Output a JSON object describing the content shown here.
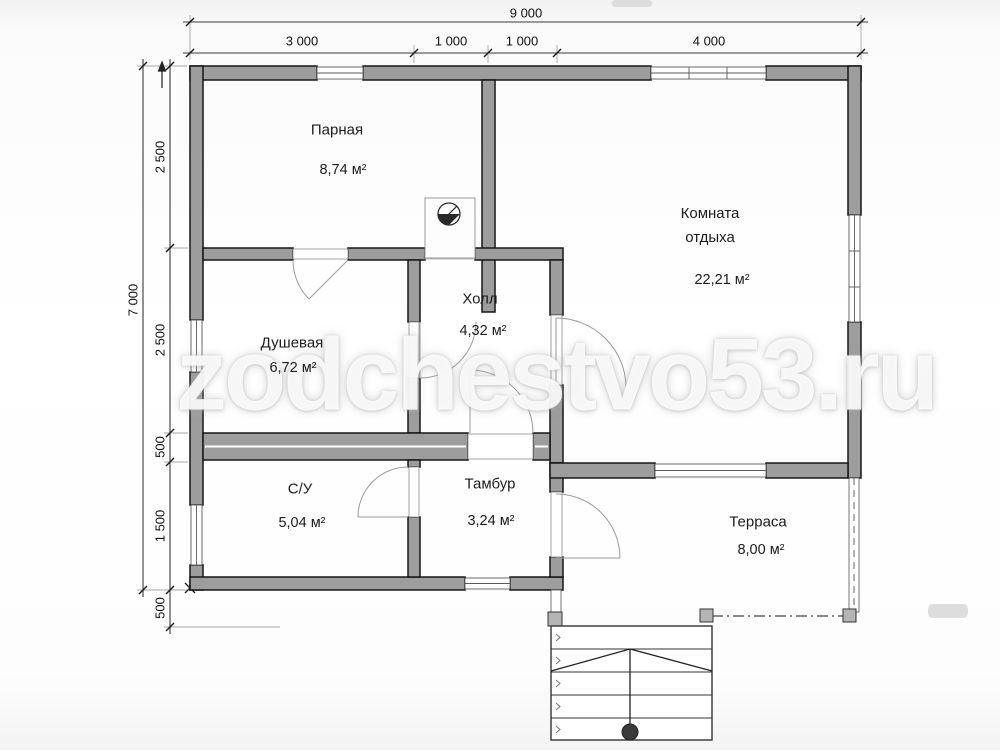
{
  "watermark": "zodchestvo53.ru",
  "rooms": [
    {
      "name": "Парная",
      "area": "8,74 м²"
    },
    {
      "name": "Комната отдыха",
      "area": "22,21 м²"
    },
    {
      "name": "Душевая",
      "area": "6,72 м²"
    },
    {
      "name": "Холл",
      "area": "4,32 м²"
    },
    {
      "name": "С/У",
      "area": "5,04 м²"
    },
    {
      "name": "Тамбур",
      "area": "3,24 м²"
    },
    {
      "name": "Терраса",
      "area": "8,00 м²"
    }
  ],
  "dimensions": {
    "top_total": "9 000",
    "top_segments": [
      "3 000",
      "1 000",
      "1 000",
      "4 000"
    ],
    "left_total": "7 000",
    "left_segments": [
      "2 500",
      "2 500",
      "500",
      "1 500",
      "500"
    ]
  }
}
